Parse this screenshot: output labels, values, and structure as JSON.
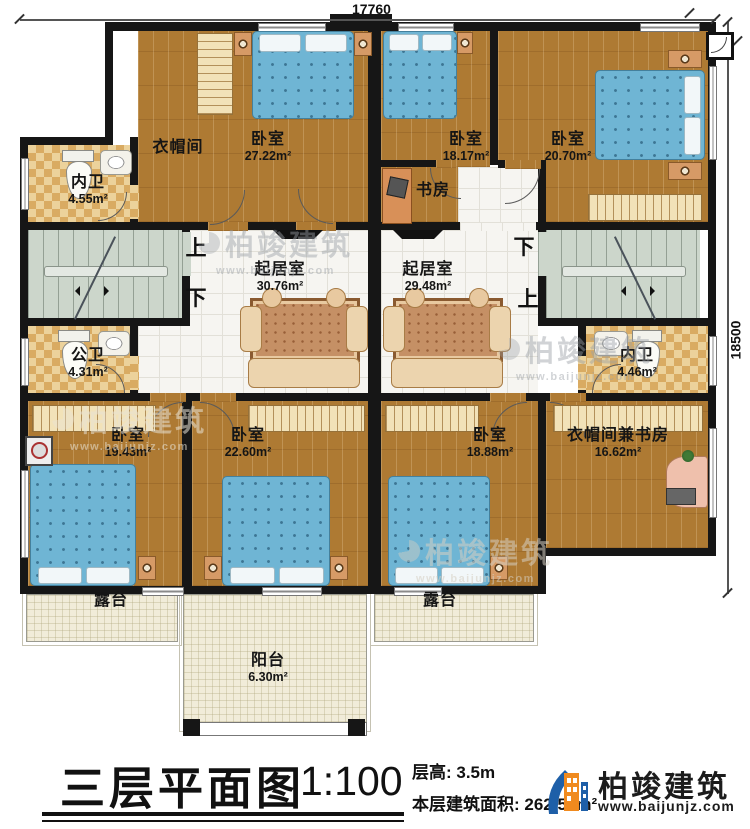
{
  "dimensions": {
    "top": "17760",
    "right": "18500"
  },
  "rooms": {
    "closet_tl": {
      "name": "衣帽间"
    },
    "bedroom_tl": {
      "name": "卧室",
      "area": "27.22m²"
    },
    "bath_tl": {
      "name": "内卫",
      "area": "4.55m²"
    },
    "bedroom_tm": {
      "name": "卧室",
      "area": "18.17m²"
    },
    "study_tm": {
      "name": "书房"
    },
    "bedroom_tr": {
      "name": "卧室",
      "area": "20.70m²"
    },
    "living_left": {
      "name": "起居室",
      "area": "30.76m²"
    },
    "living_right": {
      "name": "起居室",
      "area": "29.48m²"
    },
    "bath_ml": {
      "name": "公卫",
      "area": "4.31m²"
    },
    "bath_mr": {
      "name": "内卫",
      "area": "4.46m²"
    },
    "bedroom_bl": {
      "name": "卧室",
      "area": "19.43m²"
    },
    "bedroom_bm1": {
      "name": "卧室",
      "area": "22.60m²"
    },
    "bedroom_bm2": {
      "name": "卧室",
      "area": "18.88m²"
    },
    "closet_br": {
      "name": "衣帽间兼书房",
      "area": "16.62m²"
    },
    "terrace_left": {
      "name": "露台"
    },
    "terrace_right": {
      "name": "露台"
    },
    "balcony": {
      "name": "阳台",
      "area": "6.30m²"
    }
  },
  "stairs": {
    "up": "上",
    "down": "下"
  },
  "footer": {
    "title": "三层平面图",
    "scale": "1:100",
    "floor_height": "层高: 3.5m",
    "floor_area": "本层建筑面积: 262.56m²",
    "brand": "柏竣建筑",
    "website": "www.baijunjz.com"
  },
  "watermark": {
    "brand": "柏竣建筑",
    "website": "www.baijunjz.com"
  }
}
